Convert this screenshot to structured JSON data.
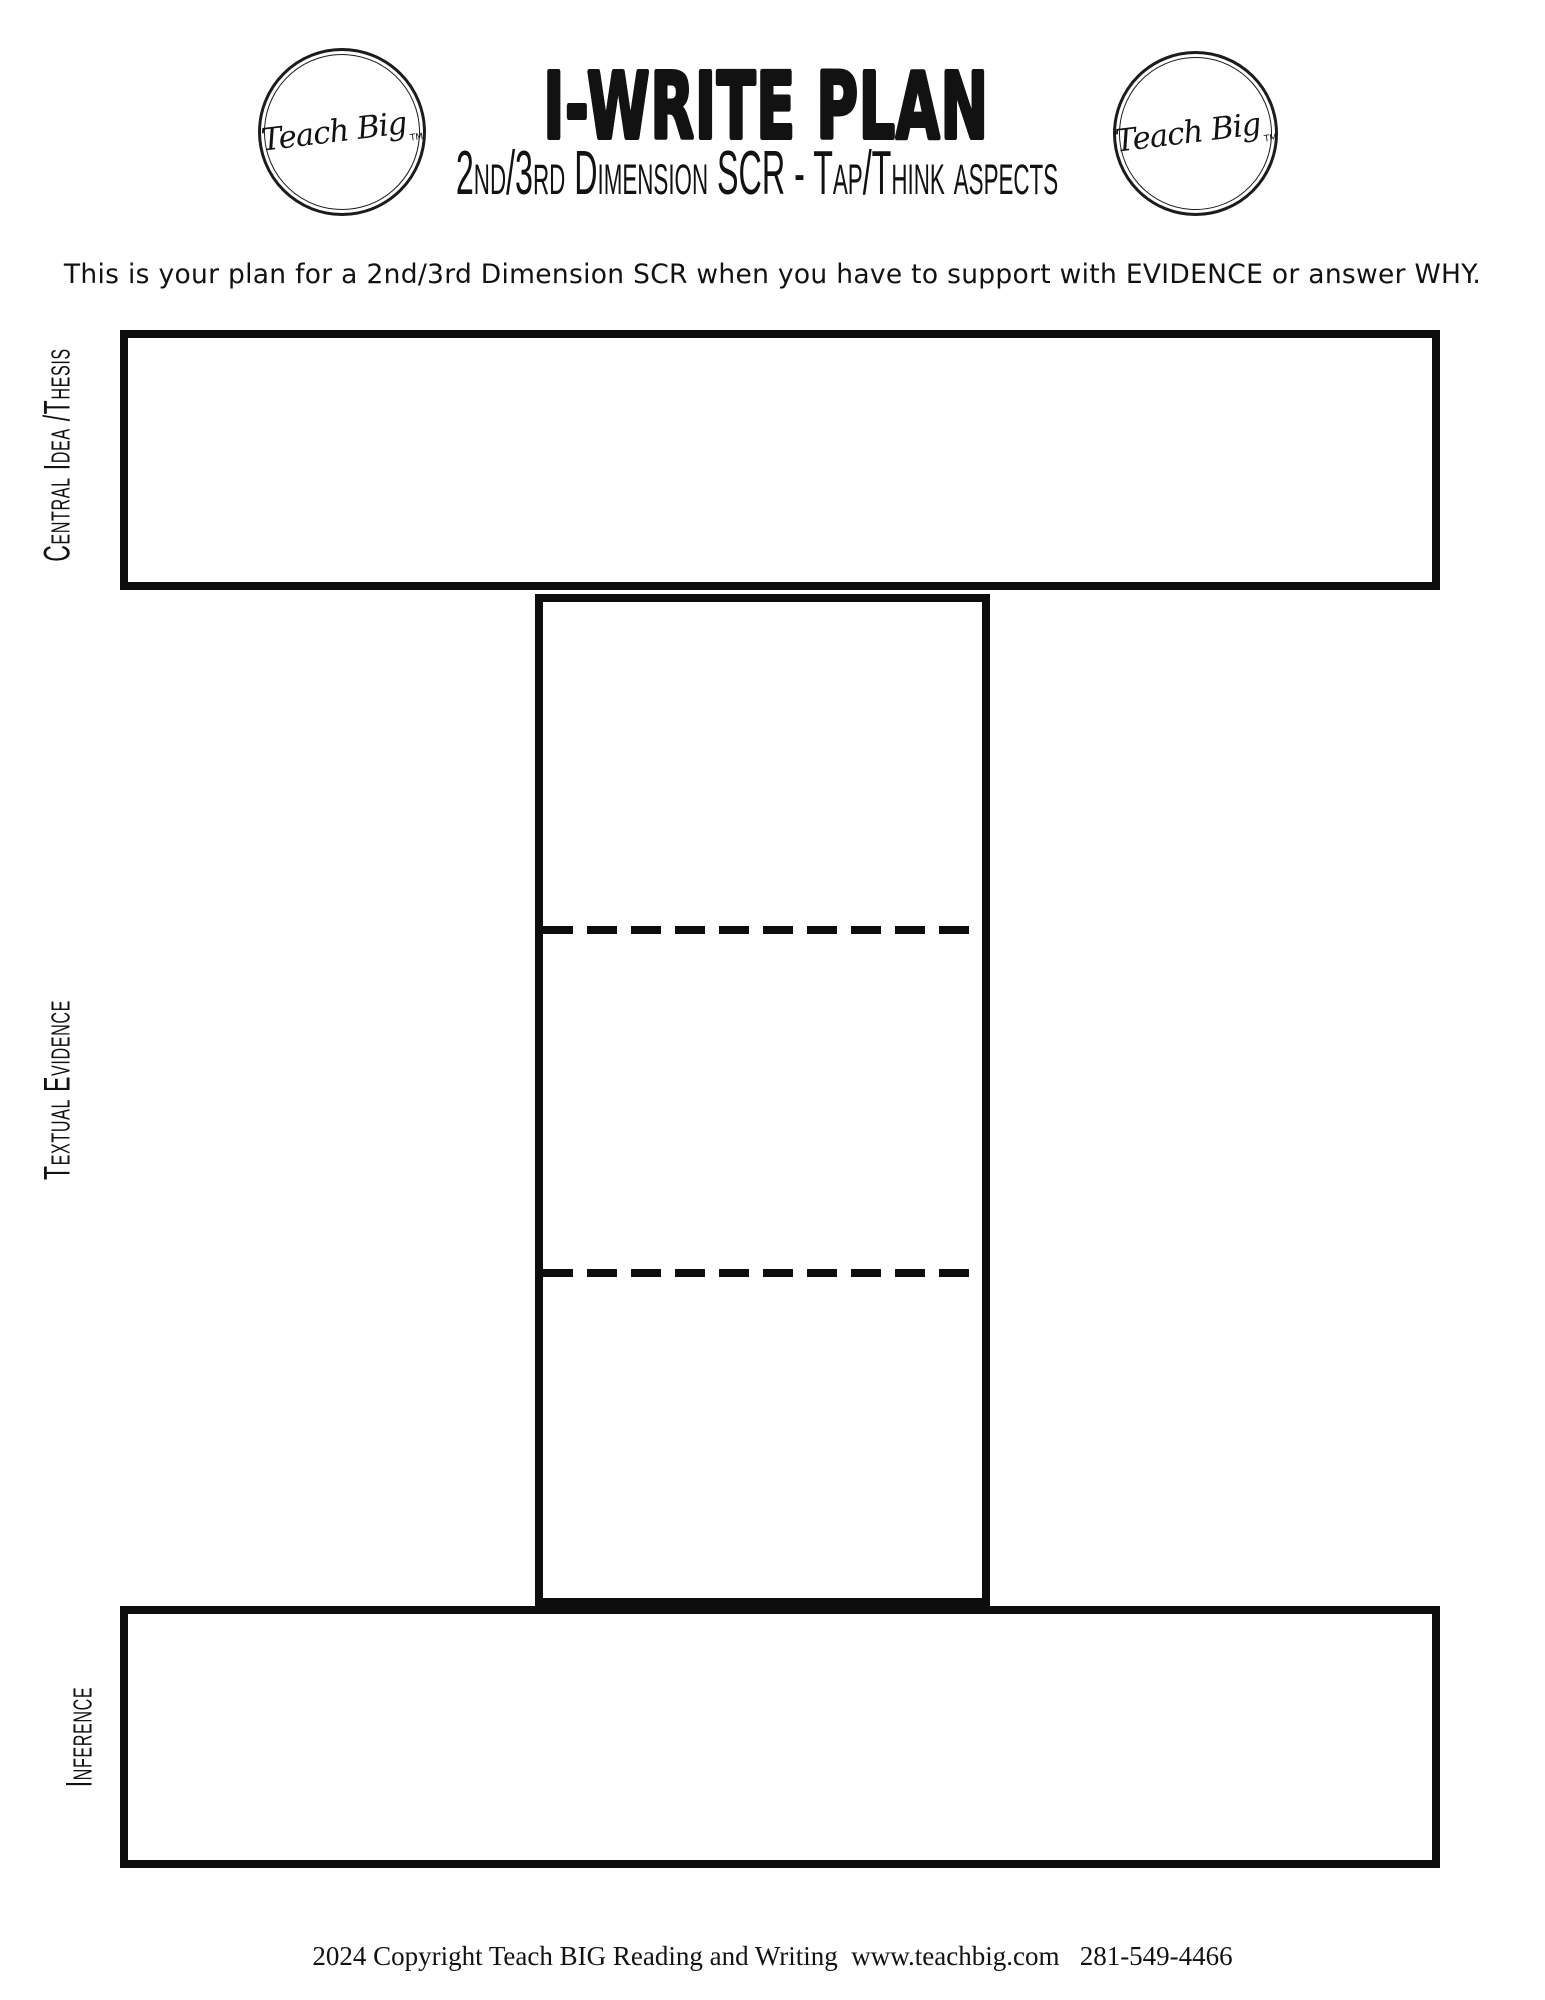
{
  "page": {
    "title": "I-WRITE PLAN",
    "subtitle": "2nd/3rd Dimension SCR - Tap/Think aspects",
    "description": "This is your plan for a 2nd/3rd Dimension SCR when you have to support with EVIDENCE or answer WHY.",
    "footer": "2024 Copyright Teach BIG Reading and Writing  www.teachbig.com   281-549-4466"
  },
  "logo": {
    "text": "Teach Big",
    "tm": "TM"
  },
  "diagram": {
    "sections": {
      "central_idea": {
        "label": "Central Idea /Thesis"
      },
      "textual_evidence": {
        "label": "Textual Evidence"
      },
      "inference": {
        "label": "Inference"
      }
    }
  },
  "colors": {
    "ink": "#121212",
    "paper": "#ffffff"
  }
}
